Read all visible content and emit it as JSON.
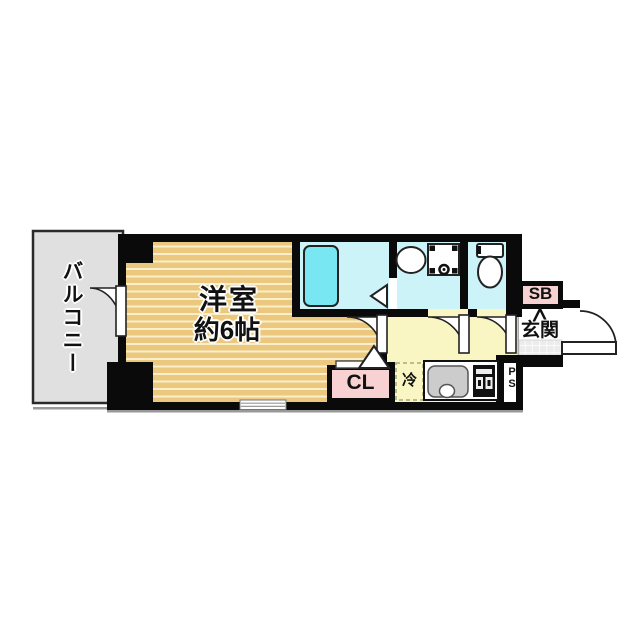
{
  "plan": {
    "balcony_label": "バルコニー",
    "room": {
      "name": "洋室",
      "size": "約6帖"
    },
    "closet_label": "CL",
    "fridge_label": "冷",
    "shoebox_label": "SB",
    "entrance_label": "玄関",
    "pipe_space_label": "PS",
    "colors": {
      "wall": "#0a0a0a",
      "flooring_tan": "#ebc87d",
      "flooring_line": "#f9efcb",
      "wet_area_cyan": "#cbf3f8",
      "bathtub_cyan": "#79e7f2",
      "hallway_yellow": "#f9f6c4",
      "closet_pink": "#f8d2d2",
      "balcony_gray": "#e0e0e0"
    }
  }
}
